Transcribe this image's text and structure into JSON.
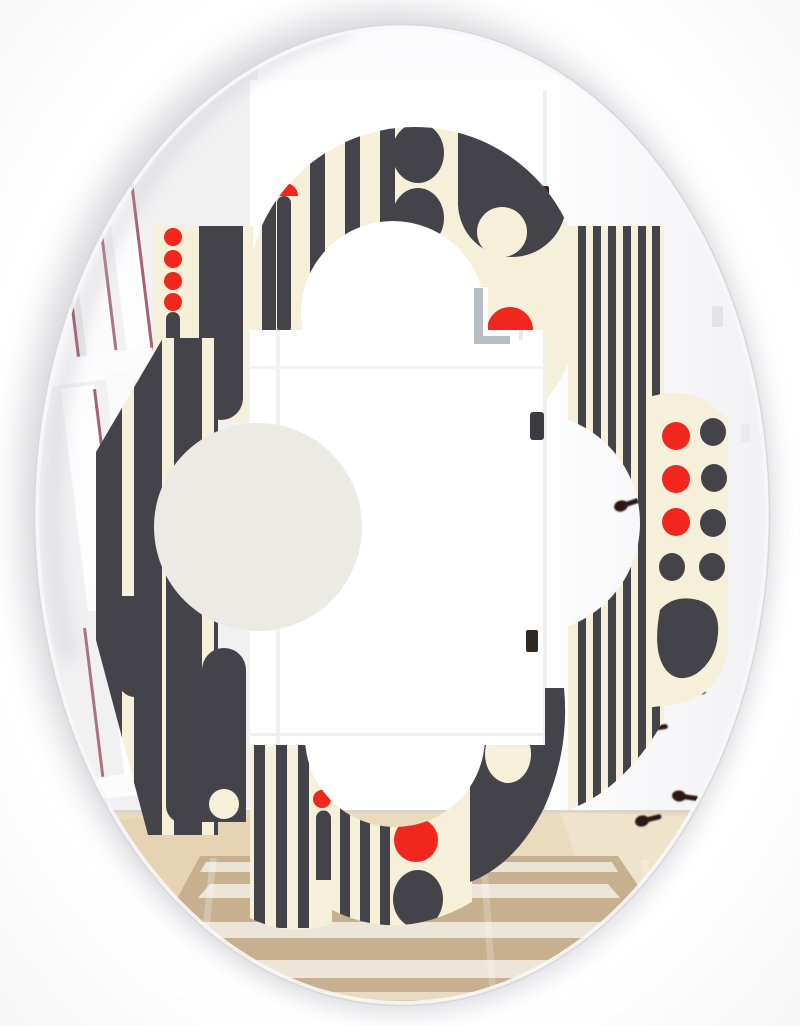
{
  "meta": {
    "type": "product-photo",
    "subject": "Oval wall mirror printed with a black, cream and red mid-century retro geometric quatrefoil pattern, reflecting a bright white hallway",
    "width": 800,
    "height": 1026
  },
  "palette": {
    "page_bg": "#ffffff",
    "mirror_face": "#fdfdfd",
    "pattern_ink": "#45434a",
    "pattern_cream": "#f6f0da",
    "pattern_red": "#f1261c",
    "clear_lobe_grey": "#ebeae4",
    "wall_grey": "#f2f1f2",
    "hallway_white": "#ffffff",
    "frame_line_maroon": "#8c3d52",
    "hook_brown": "#2e1712",
    "door_hardware": "#3b2b26",
    "window_frame_grey": "#b9bdc4",
    "wood_floor": "#e7d5b6",
    "wood_floor_light": "#efe3cb",
    "rug_tan": "#c6b08f",
    "rug_stripe": "#f1ece0",
    "rug_border": "#e7dcc2",
    "rim_line": "#d8d8dd",
    "shadow": "#aeaeb4"
  },
  "mirror": {
    "shape": "oval",
    "center_x": 402,
    "center_y": 515,
    "radius_x": 367,
    "radius_y": 490
  },
  "pattern": {
    "style": "mid-century retro geometric",
    "layout": "quatrefoil ring of patterned tiles around a clear four-lobed mirror center",
    "motifs": [
      "vertical-stripes",
      "rounded-bars",
      "capsule-stripes",
      "red-dot-columns",
      "charcoal-dot-columns",
      "charcoal-ovals",
      "red-half-circles",
      "donut-blob",
      "teardrop-blob",
      "cream-dot-cutouts"
    ],
    "red_dot_column_left_count": 4,
    "red_dot_column_right_count": 3,
    "charcoal_dot_right_count": 5
  },
  "reflection": {
    "elements": [
      "white-gallery-frames",
      "hallway-door-opening",
      "window-at-end-of-hall",
      "door-hardware-marks",
      "coat-hooks",
      "wood-floor",
      "woven-area-rug"
    ],
    "hook_count": 5,
    "frame_slat_count": 7,
    "rug_stripe_count": 3
  }
}
